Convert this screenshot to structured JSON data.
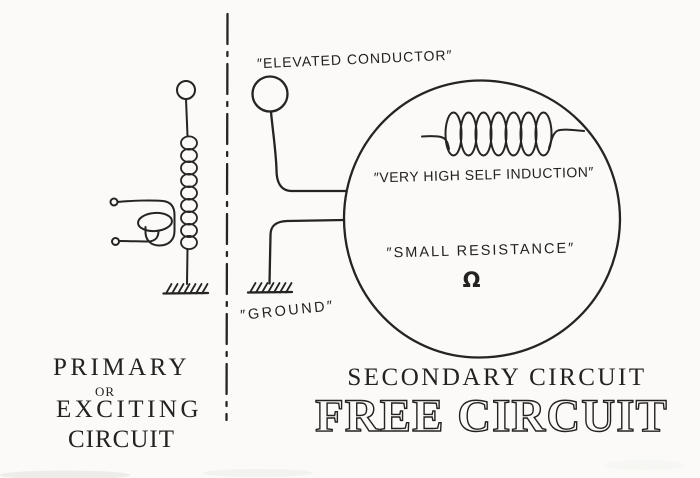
{
  "palette": {
    "paper": "#fbfaf8",
    "ink": "#242120"
  },
  "labels": {
    "elevated_conductor": "″ELEVATED CONDUCTOR″",
    "ground": "″GROUND″",
    "very_high_self_induction": "″VERY HIGH SELF INDUCTION″",
    "small_resistance": "″SMALL RESISTANCE″",
    "ohm": "Ω"
  },
  "captions": {
    "left": {
      "line1": "PRIMARY",
      "line2": "or",
      "line3": "EXCITING",
      "line4": "CIRCUIT"
    },
    "right": {
      "line1": "SECONDARY CIRCUIT",
      "line2": "FREE CIRCUIT"
    }
  }
}
